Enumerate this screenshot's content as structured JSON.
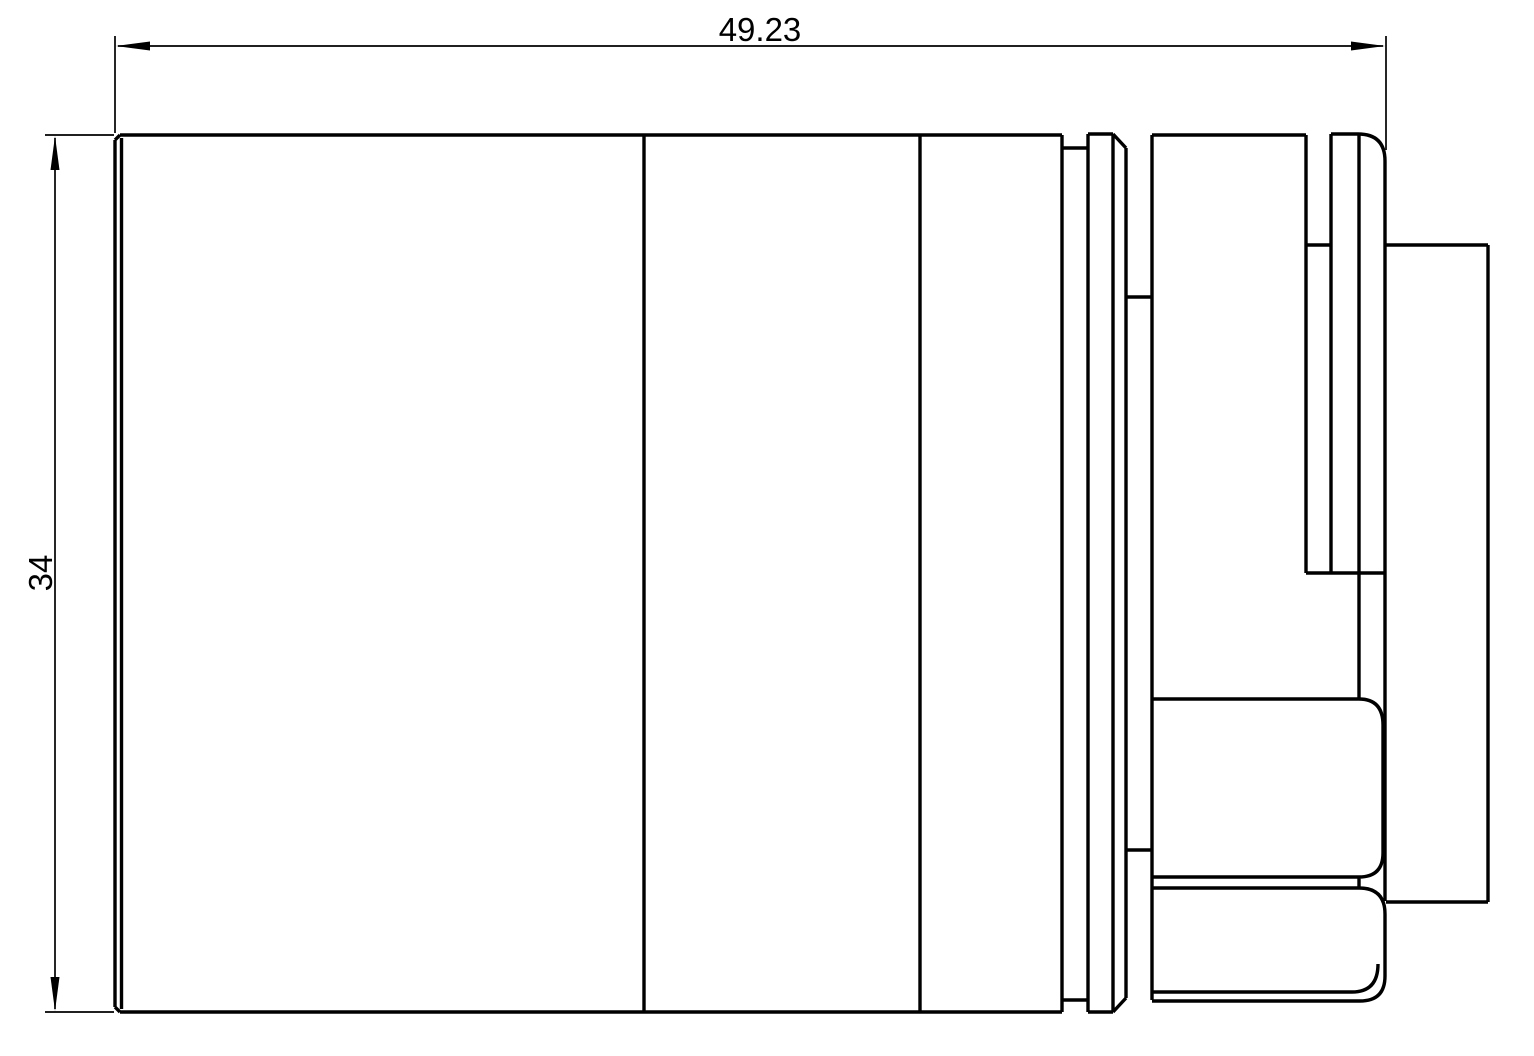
{
  "drawing": {
    "background_color": "#ffffff",
    "line_color": "#000000",
    "view_name": "lens-side-view",
    "dimension_width": {
      "label": "49.23"
    },
    "dimension_height": {
      "label": "34"
    }
  }
}
